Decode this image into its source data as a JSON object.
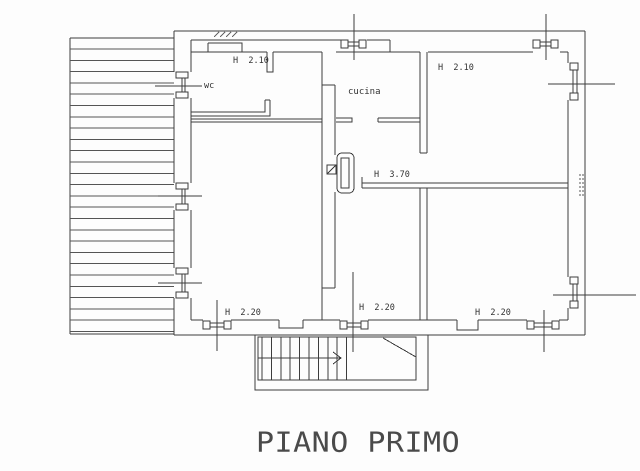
{
  "title": "PIANO PRIMO",
  "labels": {
    "wc_room_height": "H  2.10",
    "wc": "wc",
    "kitchen": "cucina",
    "bedroom_top_right_height": "H  2.10",
    "hall_height": "H  3.70",
    "room_left_height": "H  2.20",
    "hall_bottom_height": "H  2.20",
    "bedroom_bottom_right_height": "H  2.20"
  },
  "icons": {
    "window_count": 7,
    "door_count": 3
  },
  "colors": {
    "line": "#3d3d3d",
    "text": "#333333",
    "title_text": "#4a4a4a",
    "background": "#fdfdfd"
  }
}
